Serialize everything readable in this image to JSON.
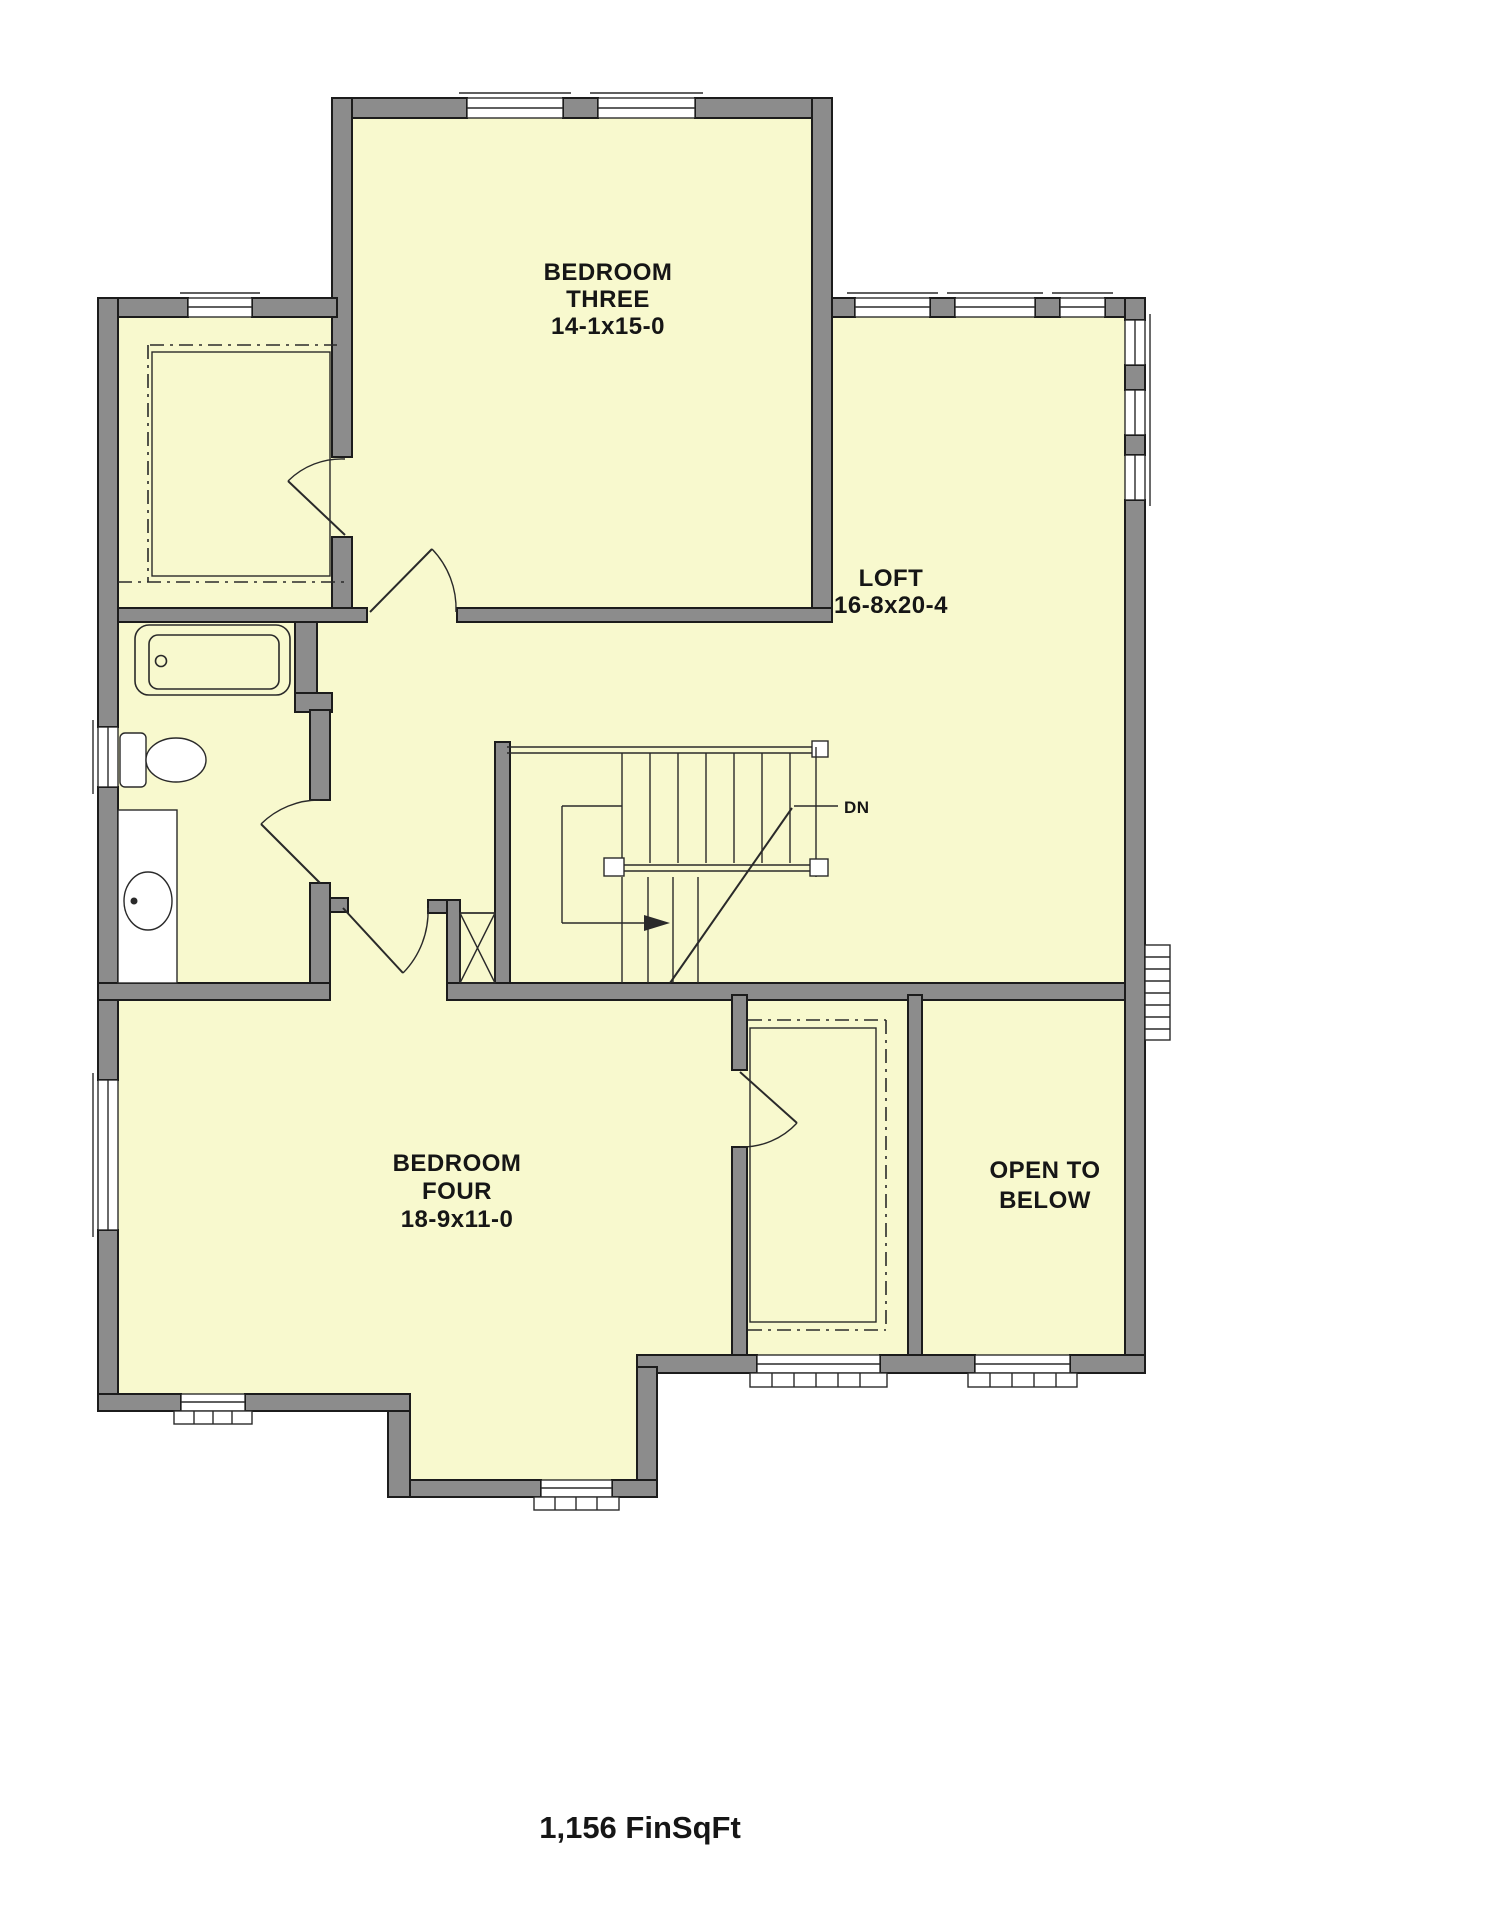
{
  "rooms": {
    "bedroom_three": {
      "name_line1": "BEDROOM",
      "name_line2": "THREE",
      "dimensions": "14-1x15-0"
    },
    "loft": {
      "name": "LOFT",
      "dimensions": "16-8x20-4"
    },
    "bedroom_four": {
      "name_line1": "BEDROOM",
      "name_line2": "FOUR",
      "dimensions": "18-9x11-0"
    },
    "open_to_below": {
      "name_line1": "OPEN TO",
      "name_line2": "BELOW"
    }
  },
  "stairs": {
    "direction_label": "DN"
  },
  "footer": {
    "area_text": "1,156 FinSqFt"
  },
  "colors": {
    "background": "#FFFFFF",
    "floor": "#F8F9CE",
    "wall": "#8C8C8C",
    "outline": "#1C1C1C"
  }
}
